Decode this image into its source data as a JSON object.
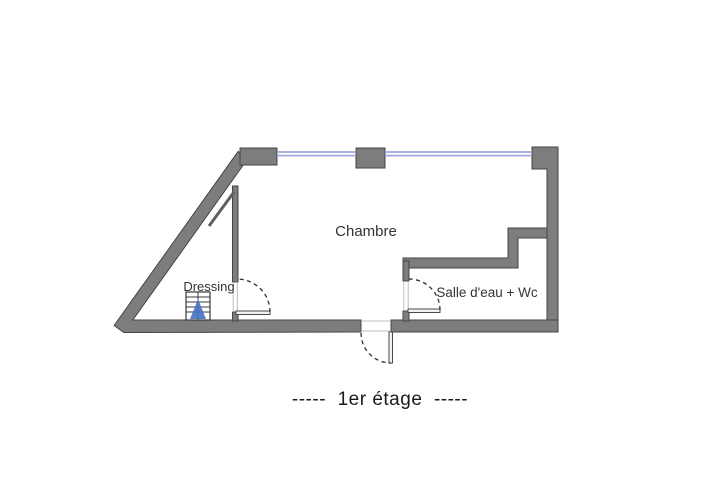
{
  "floorplan": {
    "caption": "-----  1er étage  -----",
    "rooms": [
      {
        "id": "chambre",
        "label": "Chambre"
      },
      {
        "id": "dressing",
        "label": "Dressing"
      },
      {
        "id": "salle-deau-wc",
        "label": "Salle d'eau + Wc"
      }
    ],
    "icons": [
      {
        "name": "stairs-icon",
        "meaning": "staircase with blue up-direction arrow"
      },
      {
        "name": "door-swing-arc",
        "meaning": "dashed quarter-circle door swing"
      },
      {
        "name": "window-line",
        "meaning": "thin double blue line in top wall"
      }
    ],
    "colors": {
      "background": "#ffffff",
      "wall_fill": "#7d7d7d",
      "wall_outline": "#454545",
      "window_blue": "#9ea8d8",
      "stairs_arrow_blue": "#4472c4",
      "door_swing_dark": "#2f2f2f",
      "label_text": "#333333",
      "caption_text": "#1a1a1a"
    }
  }
}
